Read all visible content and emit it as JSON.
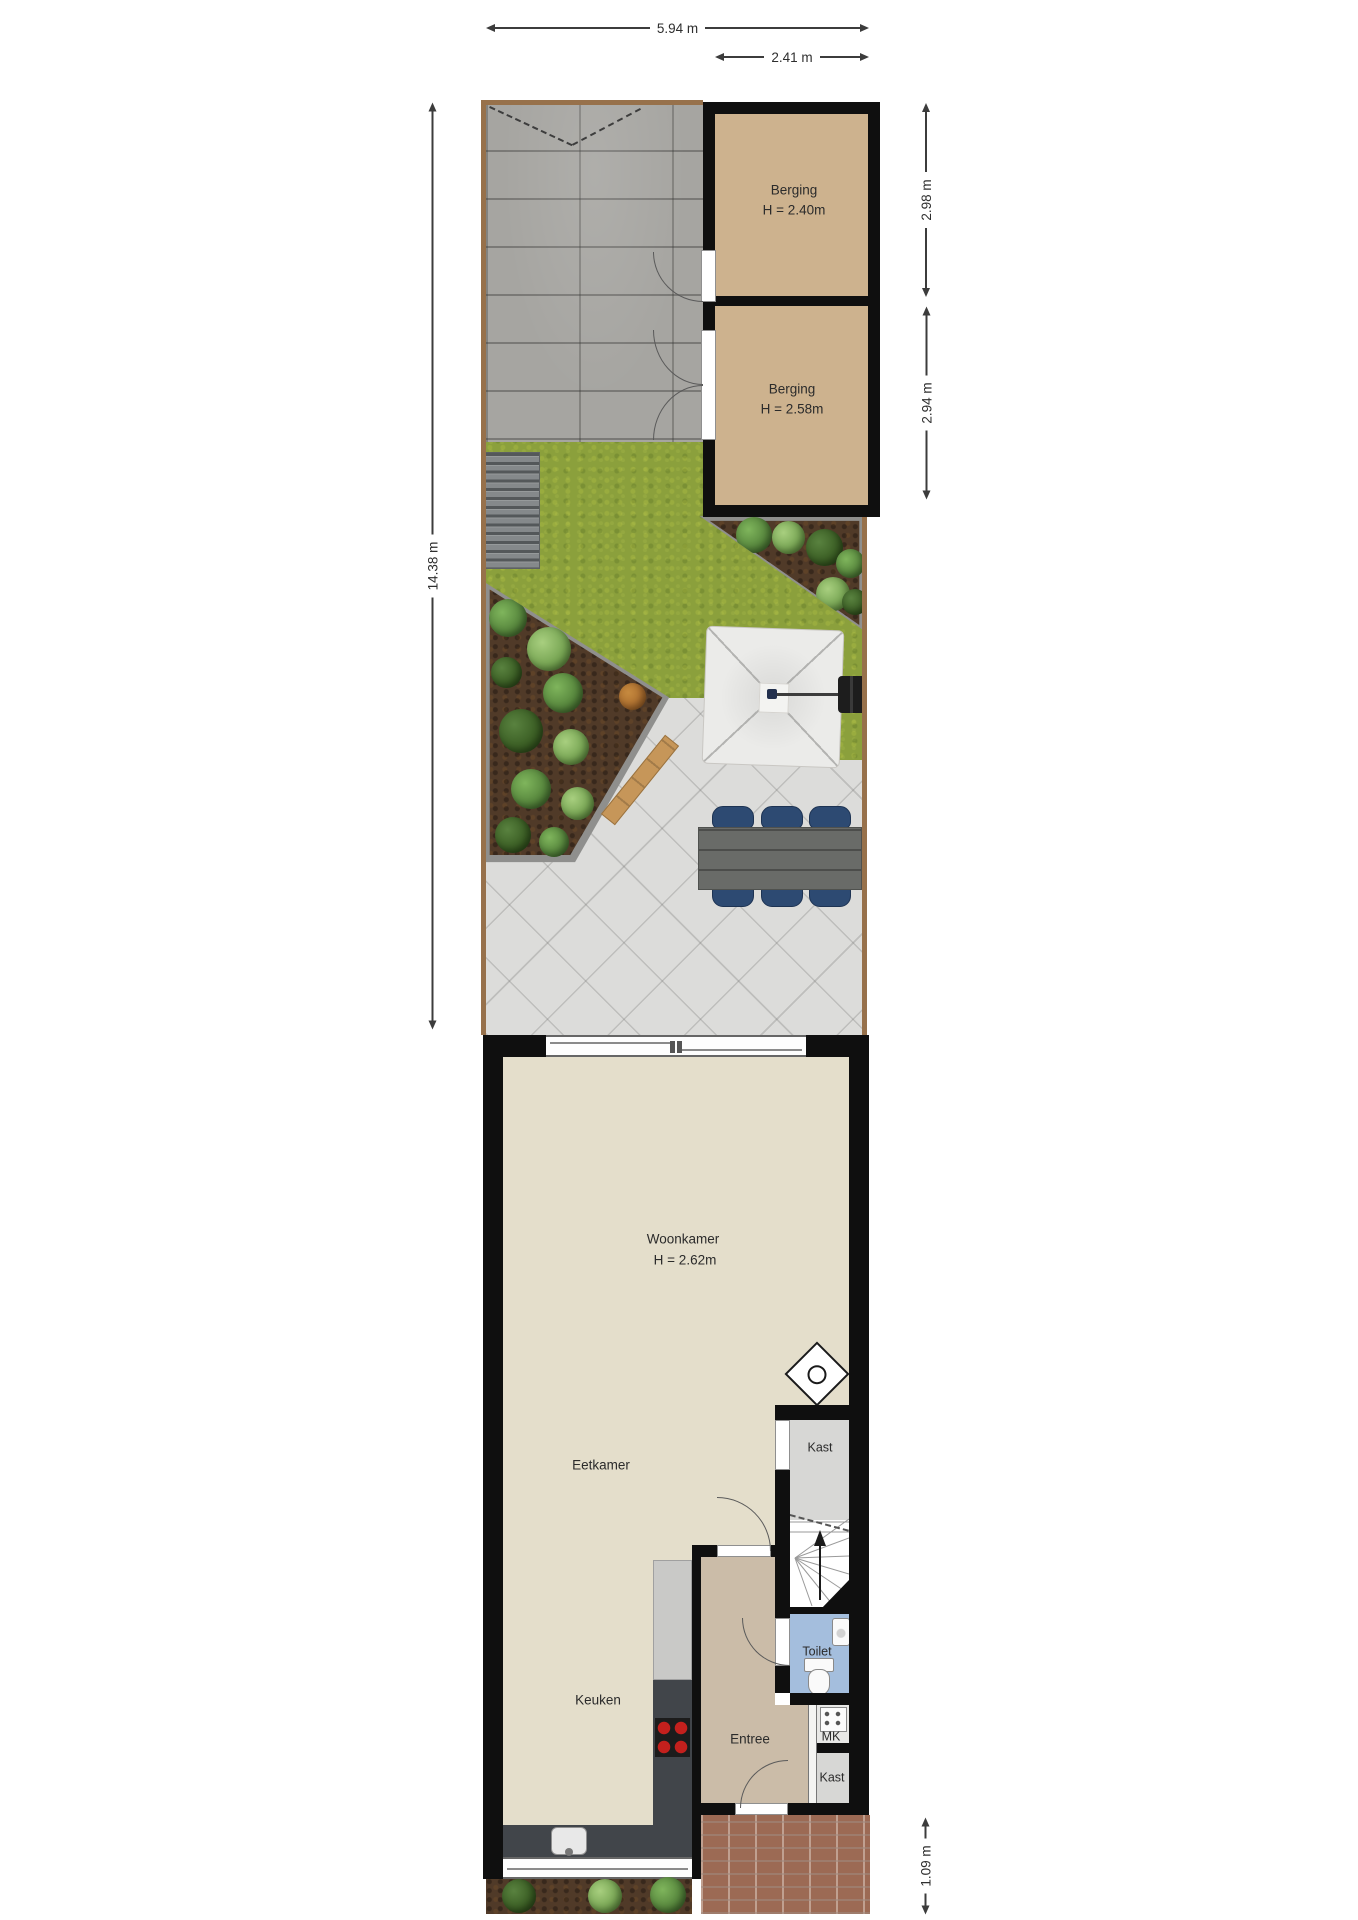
{
  "dimensions": {
    "garden_width": "5.94 m",
    "berging_width": "2.41 m",
    "berging1_depth": "2.98 m",
    "berging2_depth": "2.94 m",
    "garden_length": "14.38 m",
    "front_path_depth": "1.09 m"
  },
  "rooms": {
    "berging1": {
      "label": "Berging",
      "height": "H = 2.40m"
    },
    "berging2": {
      "label": "Berging",
      "height": "H = 2.58m"
    },
    "woonkamer": {
      "label": "Woonkamer",
      "height": "H = 2.62m"
    },
    "eetkamer": {
      "label": "Eetkamer"
    },
    "keuken": {
      "label": "Keuken"
    },
    "entree": {
      "label": "Entree"
    },
    "toilet": {
      "label": "Toilet"
    },
    "kast_hal": {
      "label": "Kast"
    },
    "meterkast": {
      "label": "MK"
    },
    "kast_entree": {
      "label": "Kast"
    }
  },
  "colors": {
    "wall": "#0f0f0f",
    "berging_floor": "#cdb28e",
    "living_floor": "#e4decb",
    "entree_floor": "#cbbca8",
    "closet_floor": "#d7d7d5",
    "toilet_floor": "#a4bedd",
    "grass": "#8ba03c",
    "terrace": "#dcdcda",
    "paving": "#a6a5a1",
    "soil": "#503a28",
    "brick": "#9c6a54",
    "chair": "#2d4a72",
    "counter_dark": "#41454a",
    "dimension": "#3c3c3c"
  }
}
